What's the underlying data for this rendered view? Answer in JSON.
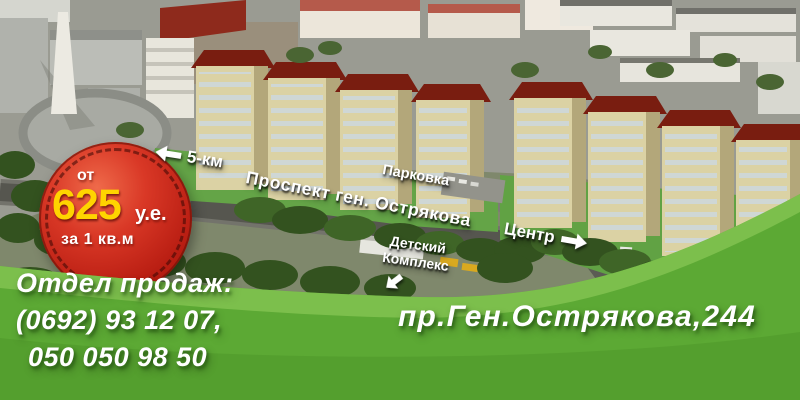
{
  "badge": {
    "prefix": "от",
    "price": "625",
    "currency": "у.е.",
    "per": "за 1 кв.м"
  },
  "labels": {
    "distance": "5-км",
    "avenue": "Проспект ген. Острякова",
    "parking": "Парковка",
    "center": "Центр",
    "kids_line1": "Детский",
    "kids_line2": "Комплекс"
  },
  "footer": {
    "sales_title": "Отдел продаж:",
    "phone_line1": "(0692) 93 12 07,",
    "phone_line2": "050 050 98 50",
    "address": "пр.Ген.Острякова,244"
  },
  "icons": {
    "distance_arrow": "left-arrow",
    "center_arrow": "right-arrow",
    "kids_arrow": "down-left-arrow"
  },
  "colors": {
    "badge_red": "#b81d12",
    "price_yellow": "#ffd400",
    "wave_green": "#5ca934",
    "wave_green_light": "#85c453",
    "wave_green_dark": "#4e9729",
    "roof_red": "#791d10",
    "facade_cream": "#dbd2a4",
    "text_white": "#ffffff"
  }
}
